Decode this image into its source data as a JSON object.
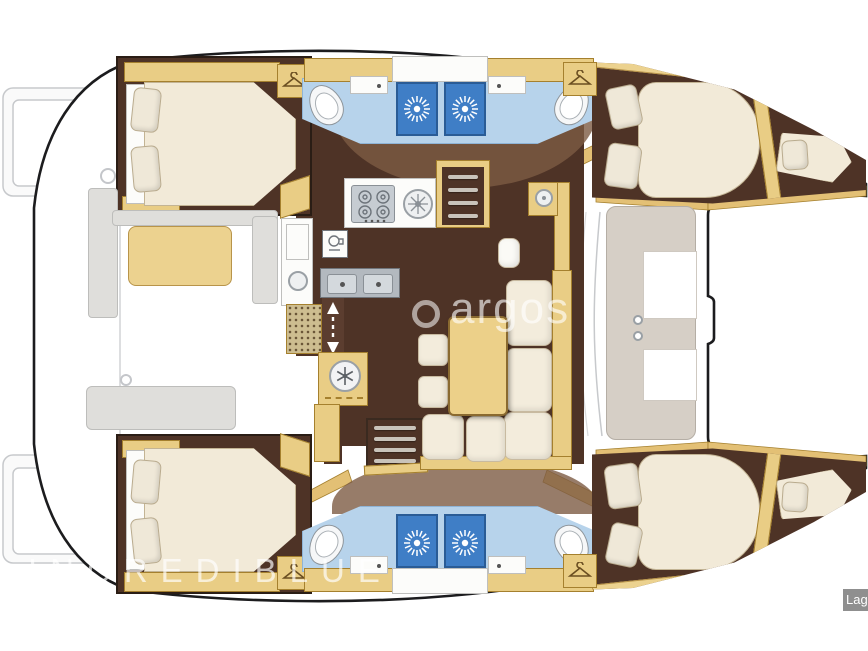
{
  "watermarks": {
    "center": "argos",
    "bottom_left": "INCREDIBLUE",
    "corner_label": "Lag"
  },
  "colors": {
    "hull_outline": "#1c1c1e",
    "floor_dark_brown": "#4e3326",
    "floor_light_brown": "#7d5b43",
    "wood_tan": "#e9cd85",
    "wood_trim": "#a5802e",
    "upholstery_cream": "#f2ead8",
    "bathroom_blue": "#b7d3eb",
    "shower_blue": "#3f7ec6",
    "stainless": "#c6ccd2",
    "exterior_gray": "#c9cacd",
    "label_bg": "#8f8f8f"
  },
  "plan": {
    "type": "catamaran-yacht-floor-plan",
    "hulls": 2,
    "rooms": [
      {
        "id": "port-aft-cabin",
        "furniture": [
          "double-bed",
          "pillows",
          "wardrobe-hanger"
        ]
      },
      {
        "id": "port-aft-bathroom",
        "furniture": [
          "toilet",
          "sink",
          "shower-cubicle"
        ]
      },
      {
        "id": "port-fwd-bathroom",
        "furniture": [
          "toilet",
          "sink",
          "shower-cubicle"
        ]
      },
      {
        "id": "port-fwd-cabin",
        "furniture": [
          "double-bed",
          "pillows",
          "forepeak-berth"
        ]
      },
      {
        "id": "starboard-aft-cabin",
        "furniture": [
          "double-bed",
          "pillows",
          "wardrobe-hanger"
        ]
      },
      {
        "id": "starboard-aft-bathroom",
        "furniture": [
          "toilet",
          "sink",
          "shower-cubicle"
        ]
      },
      {
        "id": "starboard-fwd-bathroom",
        "furniture": [
          "toilet",
          "sink",
          "shower-cubicle"
        ]
      },
      {
        "id": "starboard-fwd-cabin",
        "furniture": [
          "double-bed",
          "pillows",
          "forepeak-berth"
        ]
      },
      {
        "id": "galley",
        "furniture": [
          "stove-4-burners",
          "round-sink",
          "double-sink",
          "freezer",
          "wet-bar"
        ]
      },
      {
        "id": "salon",
        "furniture": [
          "l-shaped-sofa",
          "table",
          "stools",
          "forward-seat"
        ]
      },
      {
        "id": "cockpit",
        "furniture": [
          "bench-seat",
          "aft-bench"
        ]
      },
      {
        "id": "foredeck",
        "furniture": [
          "front-lounge"
        ]
      }
    ],
    "icons": [
      "hanger-icon",
      "shower-jet-icon",
      "snowflake-icon",
      "stove-burner-icon",
      "companionway-arrow-icon",
      "stairs",
      "doormat"
    ]
  }
}
